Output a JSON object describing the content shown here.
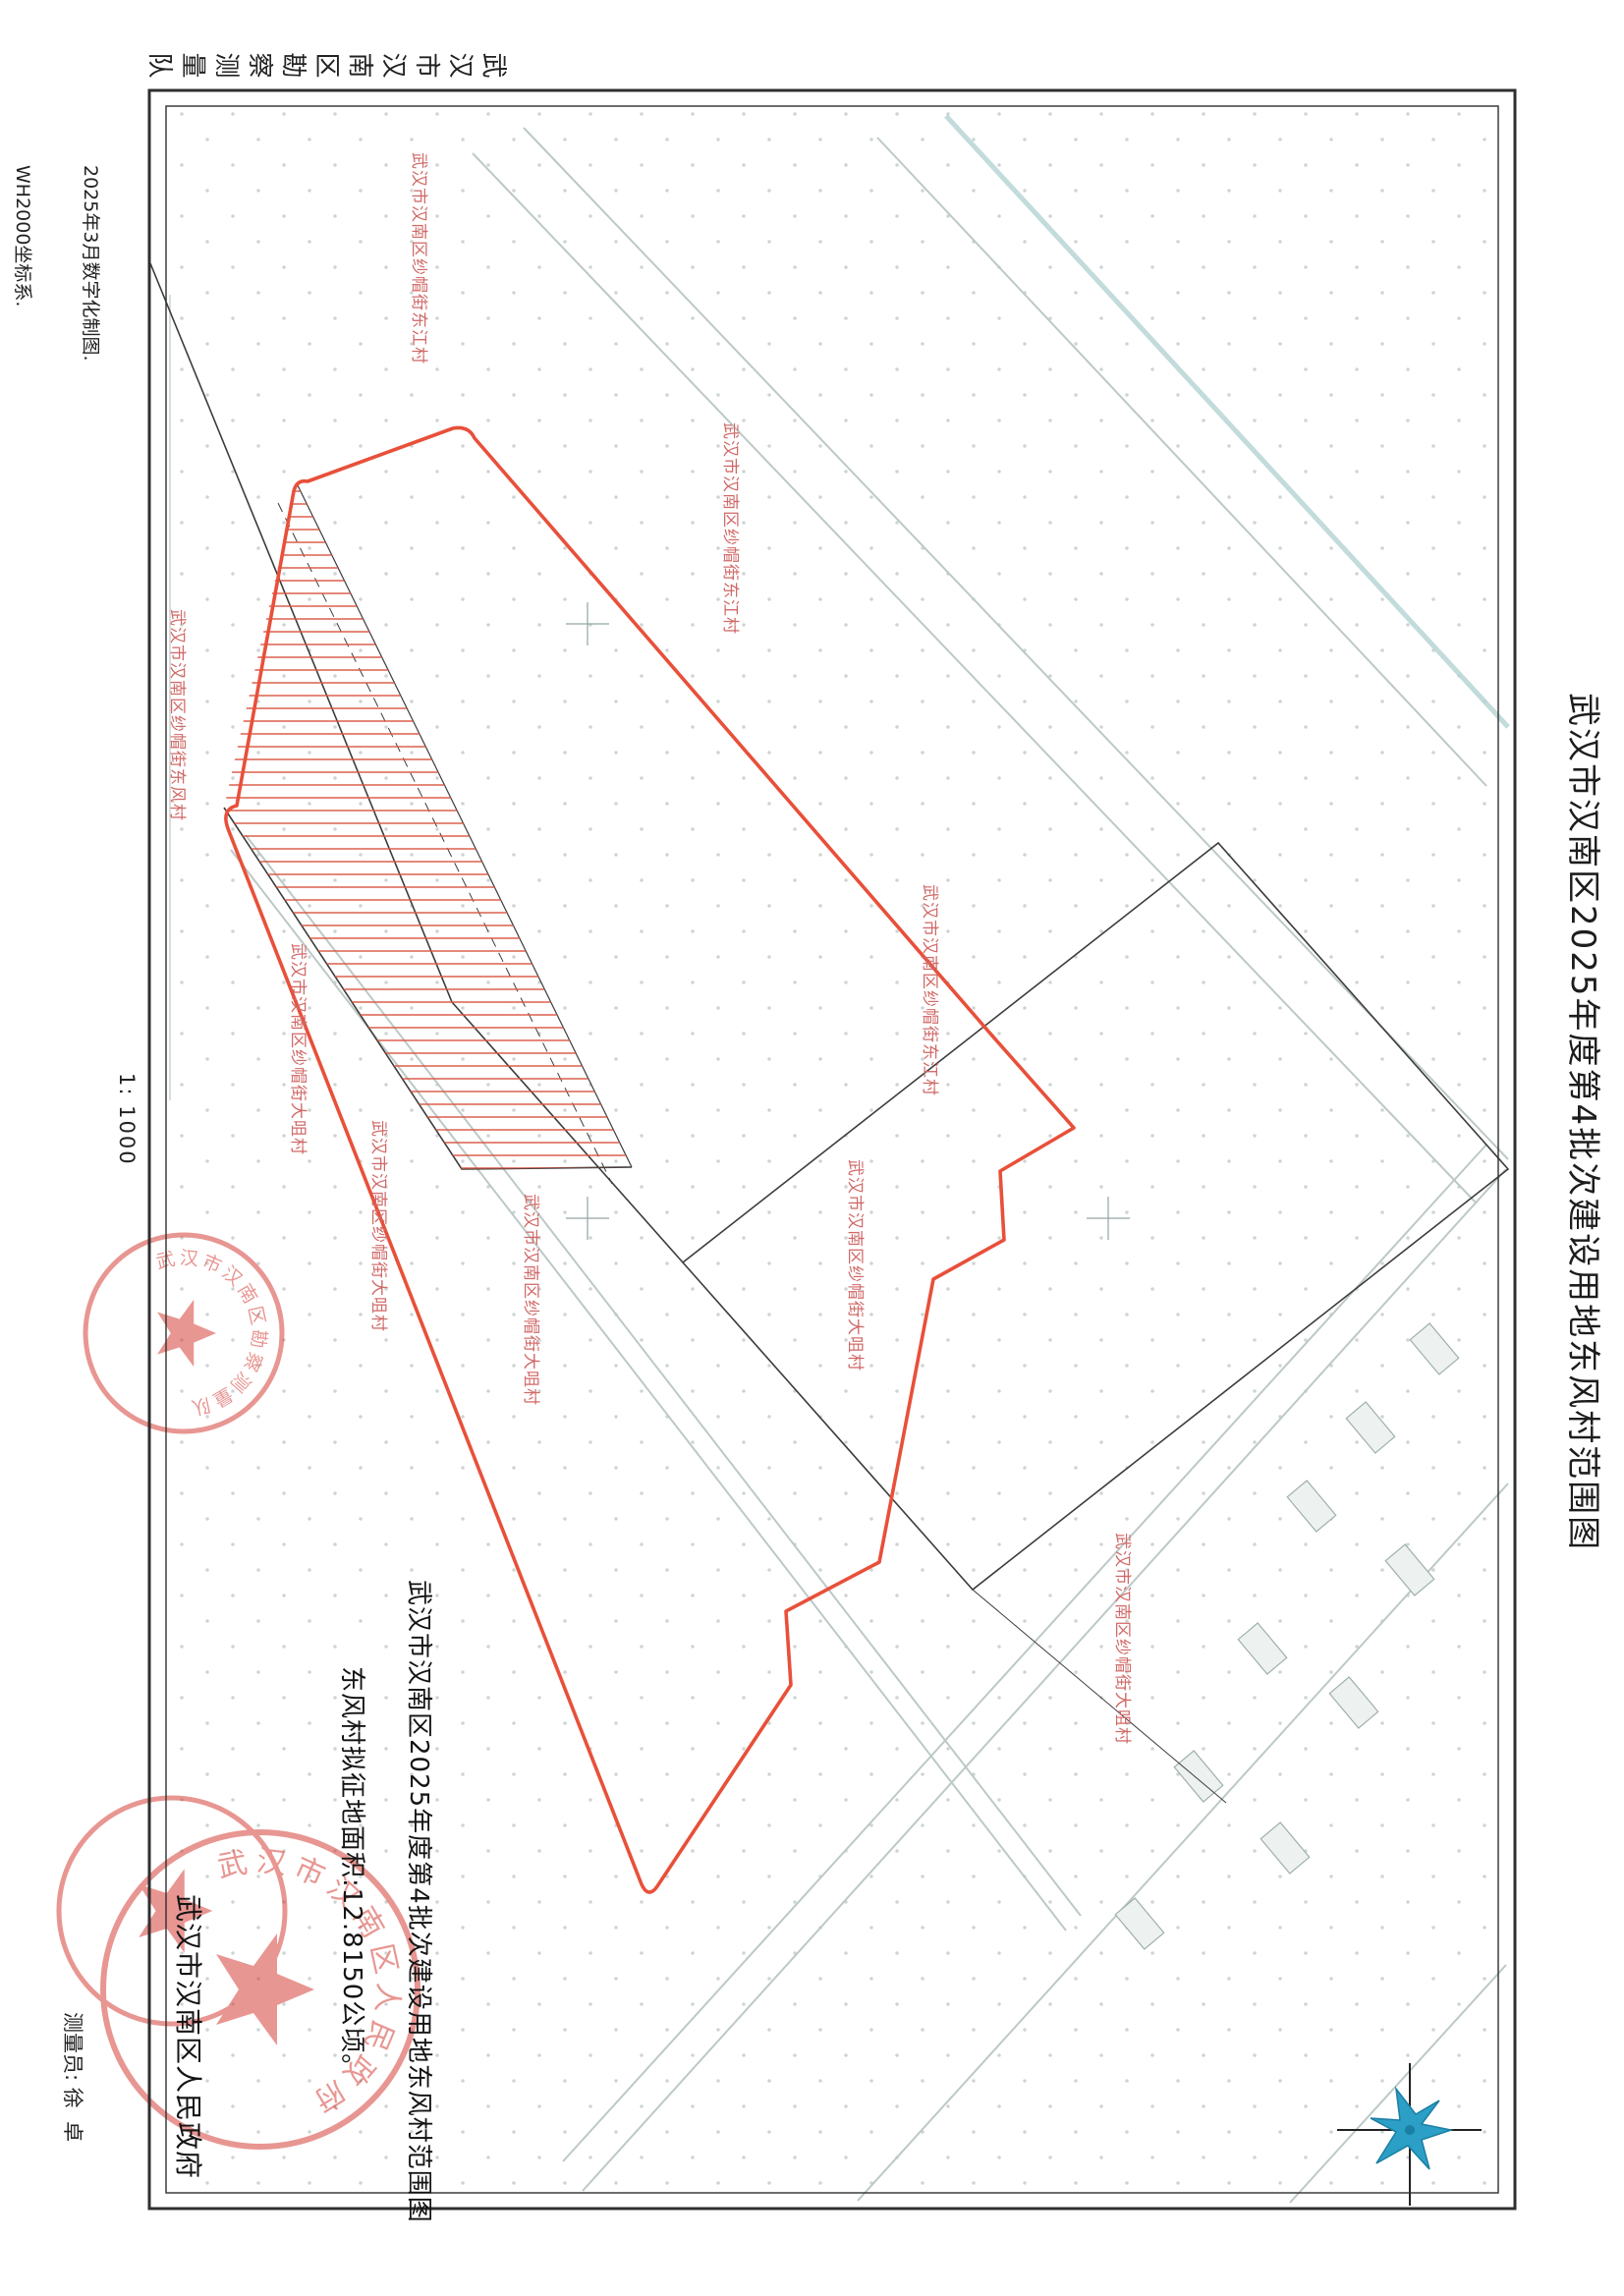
{
  "document": {
    "title": "武汉市汉南区2025年度第4批次建设用地东风村范围图",
    "scale": "1: 1000",
    "surveying_unit": "武汉市汉南区勘察测量队",
    "notes": {
      "note1": "2025年3月数字化制图.",
      "note2": "WH2000坐标系.",
      "note3": "1985国家高程基准.",
      "note4": "2007年版图式."
    }
  },
  "annotation": {
    "line1": "武汉市汉南区2025年度第4批次建设用地东风村范围图",
    "line2": "东风村拟征地面积:12.8150公顷。",
    "issuer": "武汉市汉南区人民政府"
  },
  "credits": {
    "surveyor_label": "测量员:",
    "surveyor_name": "徐  卓",
    "drafter_label": "绘图员:",
    "drafter_name": "左珉禹",
    "checker_label": "检查员:",
    "checker_name": "余胜林"
  },
  "seals": {
    "government_seal_text": "武汉市汉南区人民政府",
    "survey_seal_text": "武汉市汉南区勘察测量队"
  },
  "map_labels": [
    "武汉市汉南区纱帽街东江村",
    "武汉市汉南区纱帽街东江村",
    "武汉市汉南区纱帽街东风村",
    "武汉市汉南区纱帽街大咀村",
    "武汉市汉南区纱帽街东江村",
    "武汉市汉南区纱帽街大咀村",
    "武汉市汉南区纱帽街大咀村",
    "武汉市汉南区纱帽街大咀村",
    "武汉市汉南区纱帽街大咀村"
  ],
  "colors": {
    "boundary_red": "#e8503a",
    "hatch_red": "#d95540",
    "label_pink": "#d06a68",
    "seal_red": "#d2342b",
    "compass_blue": "#2b9fc6",
    "line_black": "#3c3c3c",
    "road_gray": "#bcc9c7"
  }
}
